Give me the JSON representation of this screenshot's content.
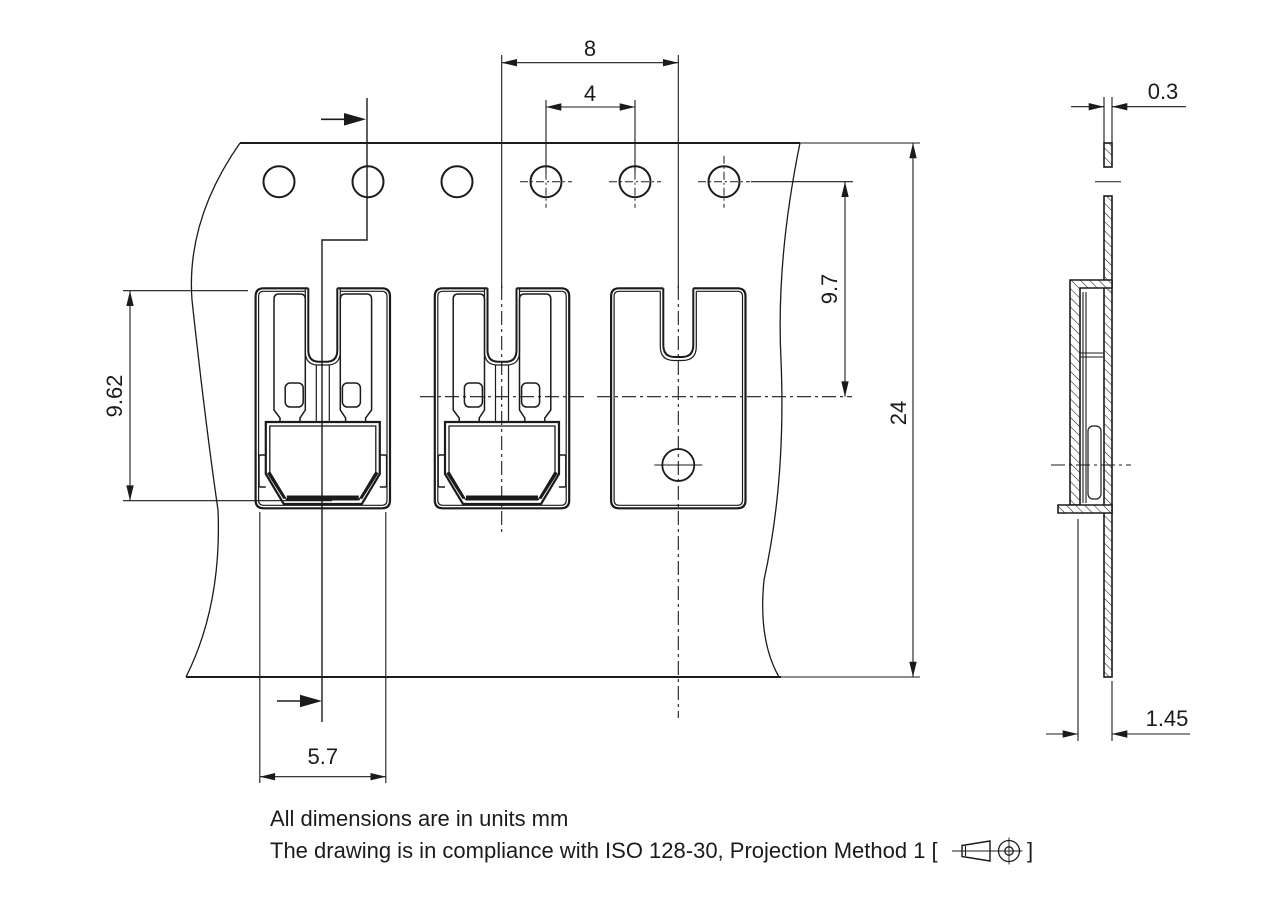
{
  "drawing": {
    "dimensions": {
      "component_pitch": "8",
      "sprocket_hole_pitch": "4",
      "hole_to_component_center": "9.7",
      "tape_width": "24",
      "component_height": "9.62",
      "component_bottom_width": "5.7",
      "tape_thickness": "0.3",
      "component_standoff": "1.45"
    },
    "notes": {
      "line1": "All dimensions are in units mm",
      "line2_prefix": "The drawing is in compliance with ISO 128-30, Projection Method 1 [",
      "line2_suffix": "]"
    }
  }
}
